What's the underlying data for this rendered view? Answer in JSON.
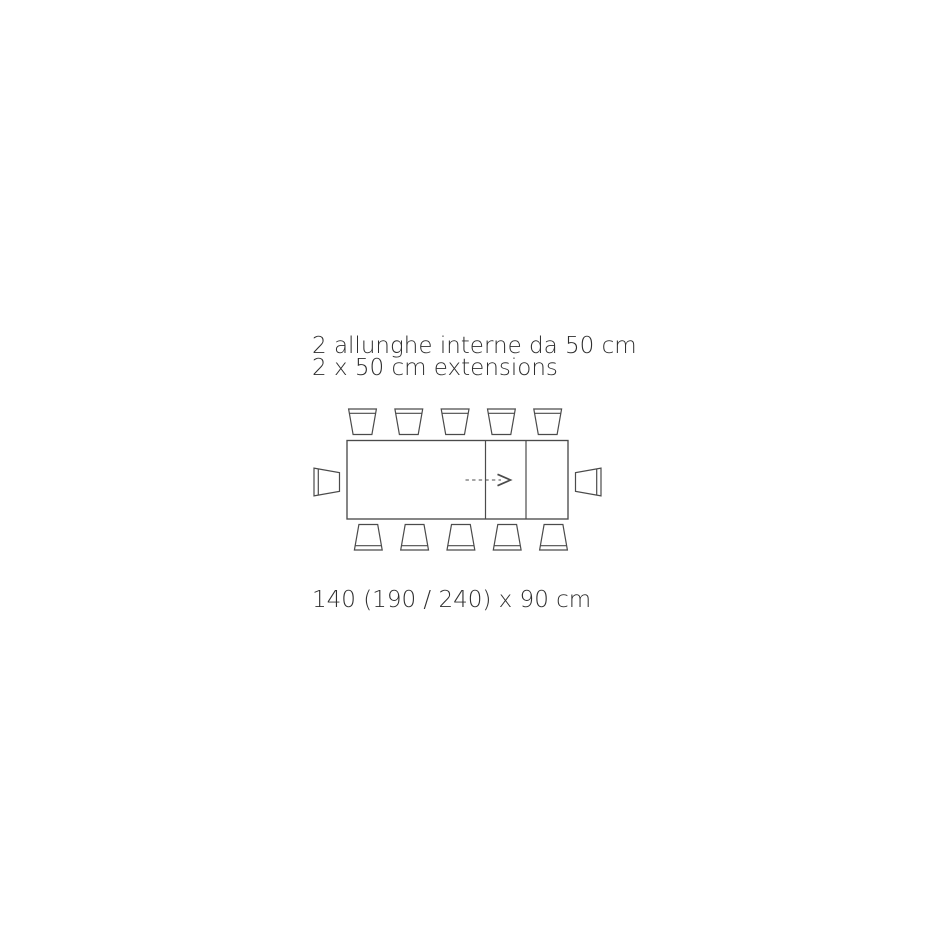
{
  "captions": {
    "italian": "2 allunghe interne da 50 cm",
    "english": "2 x 50 cm extensions",
    "dimensions": "140 (190 / 240) x 90 cm"
  },
  "product": {
    "diagram_type": "extendable-dining-table-top-view",
    "closed_length_cm": 140,
    "extended_lengths_cm": [
      190,
      240
    ],
    "depth_cm": 90,
    "extensions": {
      "count": 2,
      "size_cm": 50,
      "type": "internal"
    },
    "seats": {
      "top_row": 5,
      "bottom_row": 5,
      "left_end": 1,
      "right_end": 1,
      "total": 12
    }
  },
  "colors": {
    "line": "#4b4b4b",
    "text": "#2f2f2f",
    "background": "#ffffff"
  }
}
